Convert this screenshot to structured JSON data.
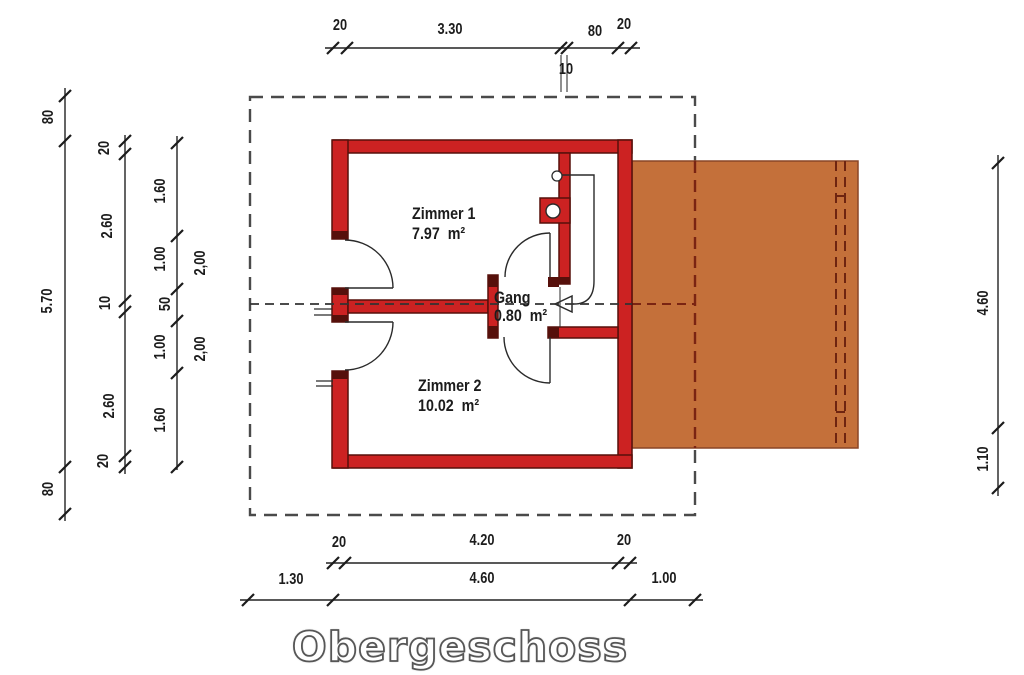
{
  "title": "Obergeschoss",
  "rooms": {
    "zimmer1": {
      "label": "Zimmer 1",
      "area": "7.97  m²"
    },
    "zimmer2": {
      "label": "Zimmer 2",
      "area": "10.02  m²"
    },
    "gang": {
      "label": "Gang",
      "area": "0.80  m²"
    }
  },
  "dims": {
    "top": [
      "20",
      "3.30",
      "10",
      "80",
      "20"
    ],
    "bottom_inner": [
      "20",
      "4.20",
      "20"
    ],
    "bottom_outer": [
      "1.30",
      "4.60",
      "1.00"
    ],
    "left_outer": [
      "80",
      "5.70",
      "80"
    ],
    "left_mid": [
      "20",
      "2.60",
      "10",
      "2.60",
      "20"
    ],
    "left_inner": [
      "1.60",
      "1.00",
      "50",
      "1.00",
      "1.60"
    ],
    "left_axis": [
      "2,00",
      "2,00"
    ],
    "right": [
      "4.60",
      "1.10"
    ]
  },
  "colors": {
    "wall_fill": "#cc2222",
    "wall_outline": "#56100b",
    "roof_fill": "#c4703a",
    "roof_edge": "#8a4526",
    "roof_hidden_line": "#7a2412",
    "overhang_dash": "#4a4a4a",
    "drawing_line": "#222222"
  }
}
